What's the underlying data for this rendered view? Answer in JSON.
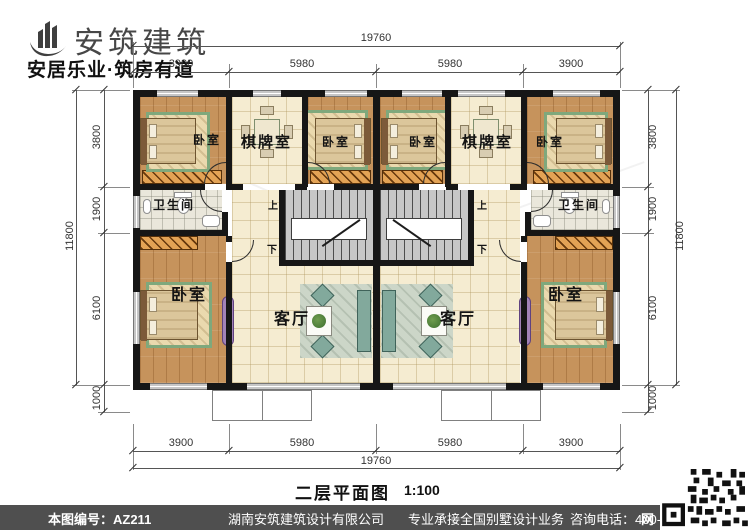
{
  "header": {
    "brand": "安筑建筑",
    "tagline": "安居乐业·筑房有道"
  },
  "rooms": {
    "bedroom": "卧室",
    "chess": "棋牌室",
    "bathroom": "卫生间",
    "living": "客厅",
    "stair_up": "上",
    "stair_down": "下"
  },
  "dims": {
    "top": {
      "overall": "19760",
      "s1": "3900",
      "s2": "5980",
      "s3": "5980",
      "s4": "3900"
    },
    "bottom": {
      "overall": "19760",
      "s1": "3900",
      "s2": "5980",
      "s3": "5980",
      "s4": "3900"
    },
    "left": {
      "overall": "11800",
      "s1": "3800",
      "s2": "1900",
      "s3": "6100",
      "s4": "1000"
    },
    "right": {
      "overall": "11800",
      "s1": "3800",
      "s2": "1900",
      "s3": "6100",
      "s4": "1000"
    }
  },
  "title": {
    "name": "二层平面图",
    "scale": "1:100"
  },
  "footer": {
    "sheet_no": "本图编号：AZ211",
    "company": "湖南安筑建筑设计有限公司",
    "service": "专业承接全国别墅设计业务",
    "phone": "咨询电话：400-8070-511",
    "web": "网"
  },
  "colors": {
    "wall": "#161616",
    "wood": "#c6935c",
    "tile": "#f5ecd1",
    "footer_bar": "#4f4f4f"
  }
}
